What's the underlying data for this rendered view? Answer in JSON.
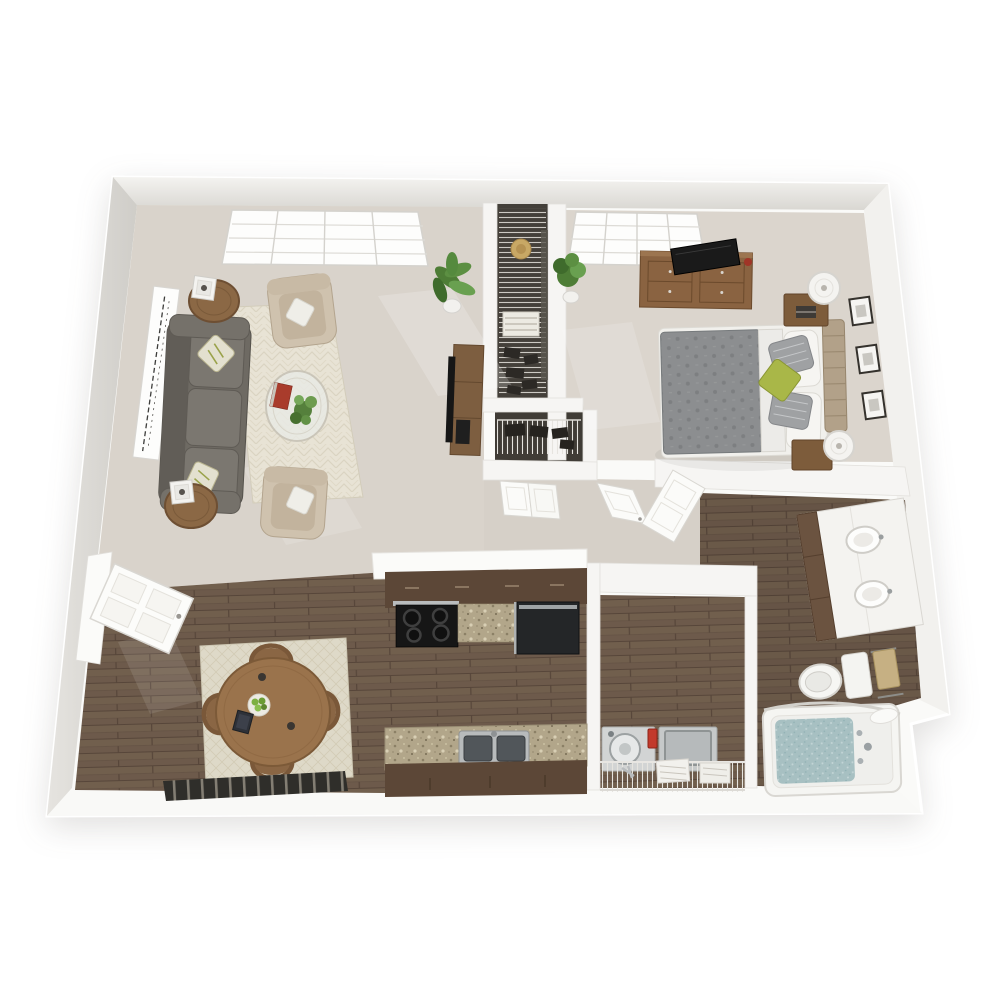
{
  "scene": {
    "type": "3d-floor-plan-rendering",
    "description": "3D top-down rendering of a one-bedroom one-bathroom apartment floor plan on a white background",
    "background_color": "#ffffff",
    "palette": {
      "wall_top": "#fafaf8",
      "wall_face_shadow": "#dcdad6",
      "carpet": "#d9d3cb",
      "hardwood": "#6d5a4b",
      "closet_floor": "#44403a",
      "cabinet_dark_brown": "#5c4737",
      "granite_counter": "#b2a68a",
      "wood_furniture": "#8a6341",
      "sofa_gray": "#6e6a63",
      "armchair_beige": "#cfc2ae",
      "rug_cream": "#e8e3d5",
      "bed_duvet_gray": "#8c8e90",
      "accent_green_pillow": "#a9b748",
      "plant_green": "#55803c",
      "tub_water_teal": "#a7c0c2",
      "appliance_black": "#1a1a1a",
      "detergent_red": "#c23a2c",
      "towel_tan": "#c6b083"
    },
    "rooms": [
      {
        "name": "living room",
        "floor": "carpet",
        "furniture": [
          "gray sofa with two patterned throw pillows",
          "tall white script wall art",
          "two round wood end tables with white candle lanterns",
          "two beige armchairs with white pillows",
          "cream chevron area rug",
          "round glass coffee table with plant and red book",
          "potted palm plant",
          "wood media console with flat-screen TV",
          "picture window with white blinds"
        ]
      },
      {
        "name": "dining area",
        "floor": "hardwood",
        "furniture": [
          "round wood dining table",
          "four hoop-back wood chairs",
          "cream diamond-pattern rug",
          "bowl of green apples",
          "dark tablet",
          "white front entry door ajar",
          "dark slatted floor vent"
        ]
      },
      {
        "name": "kitchen",
        "floor": "hardwood",
        "furniture": [
          "white counter end panel",
          "dark brown upper cabinet run",
          "black range with four burners",
          "granite counter sections",
          "black refrigerator-dishwasher unit",
          "granite counter with stainless double sink",
          "dark brown lower cabinet run"
        ]
      },
      {
        "name": "bedroom",
        "floor": "carpet",
        "furniture": [
          "window with white blinds",
          "potted plant",
          "wood dresser with flat-screen TV",
          "bed with gray patterned duvet, white and gray pillows and green accent pillow",
          "tan upholstered headboard",
          "two wood nightstands",
          "two white drum lamps",
          "three framed pictures on wall"
        ]
      },
      {
        "name": "bathroom",
        "floor": "hardwood",
        "furniture": [
          "white double-sink vanity with dark wood drawers",
          "two faucets",
          "toilet",
          "tan towel on towel bar",
          "bathtub with teal water and curved shower rod",
          "bunched white shower curtain"
        ]
      },
      {
        "name": "laundry closet",
        "floor": "hardwood",
        "furniture": [
          "top-load washer with red detergent bottle",
          "dryer",
          "wire shelf with folded towels"
        ]
      },
      {
        "name": "walk-in closet",
        "floor": "dark",
        "furniture": [
          "wire shelving",
          "sun hat",
          "folded striped blanket",
          "shoes and bags"
        ]
      },
      {
        "name": "linen closet",
        "floor": "dark",
        "furniture": [
          "wire shelf",
          "dark storage items"
        ]
      },
      {
        "name": "hallway",
        "floor": "carpet",
        "furniture": [
          "double closet doors",
          "open bedroom door",
          "open bathroom door"
        ]
      }
    ]
  }
}
